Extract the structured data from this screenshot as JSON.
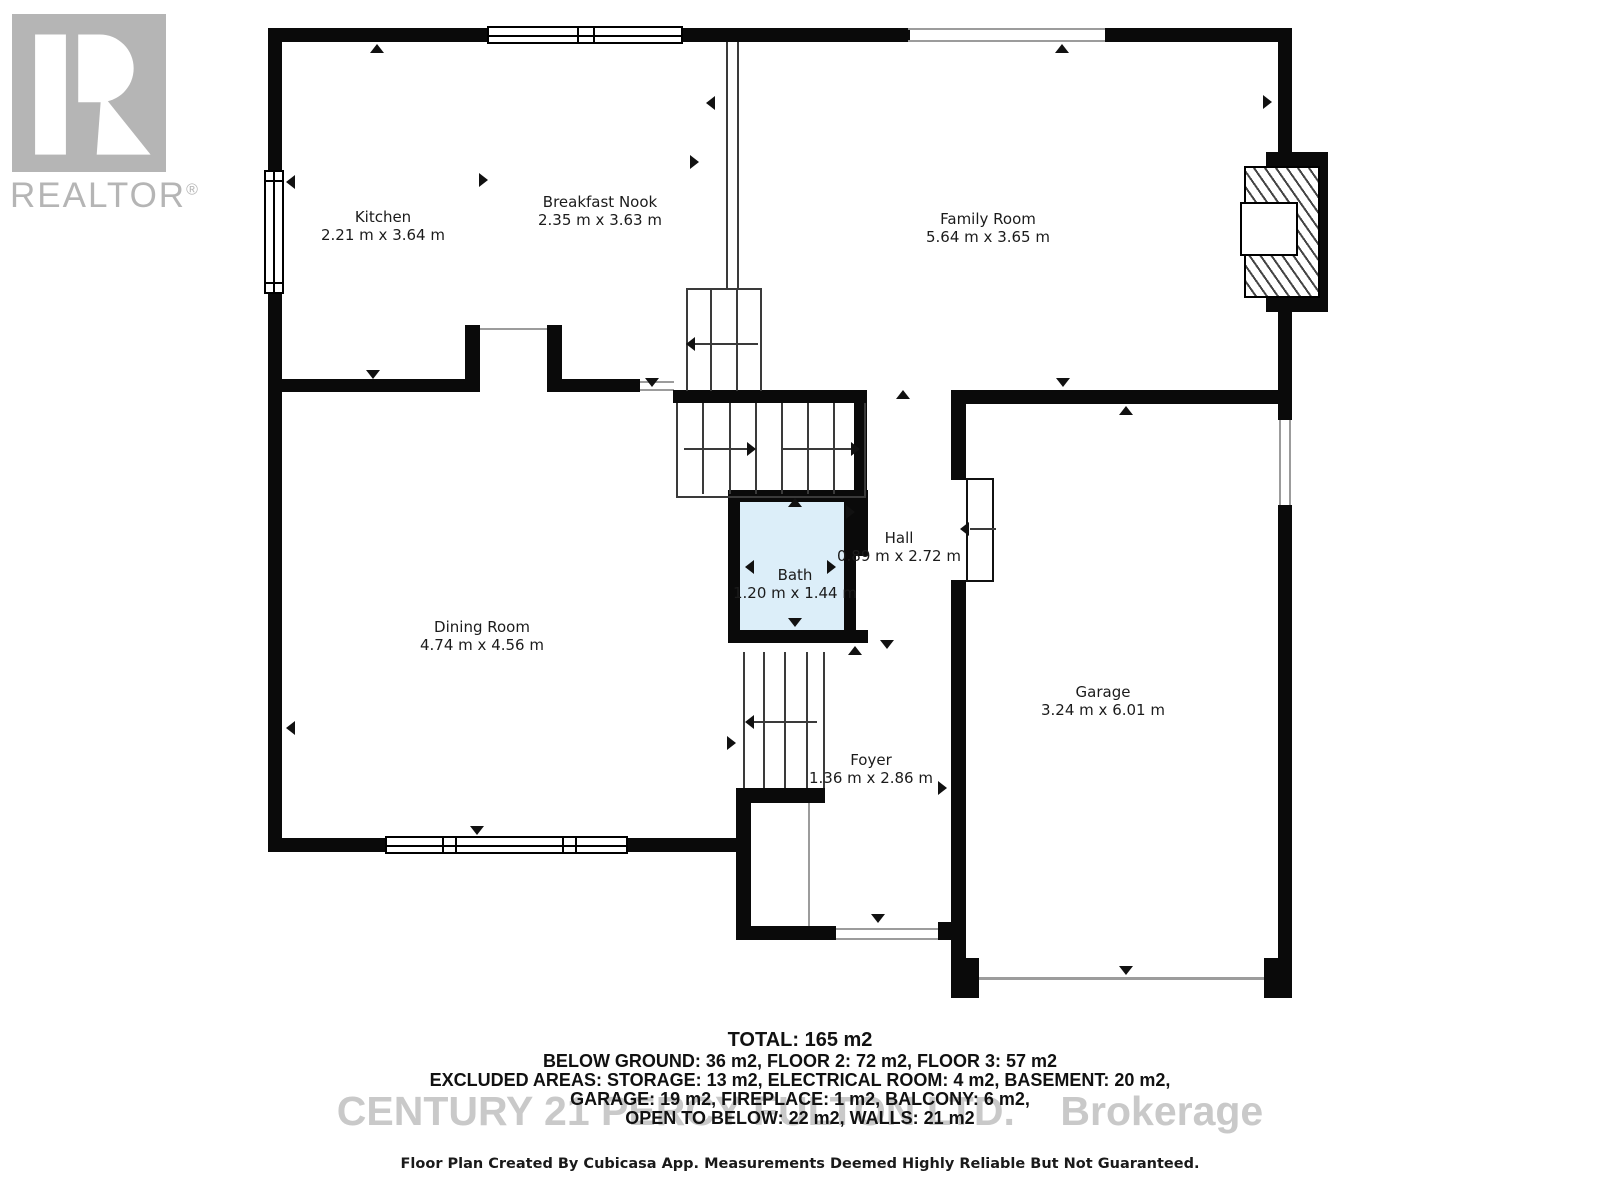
{
  "branding": {
    "logo_letter_box": "realtor-block-R",
    "logo_text": "REALTOR",
    "registered_mark": "®"
  },
  "rooms": [
    {
      "name": "Kitchen",
      "dims": "2.21 m x 3.64 m"
    },
    {
      "name": "Breakfast Nook",
      "dims": "2.35 m x 3.63 m"
    },
    {
      "name": "Family Room",
      "dims": "5.64 m x 3.65 m"
    },
    {
      "name": "Dining Room",
      "dims": "4.74 m x 4.56 m"
    },
    {
      "name": "Bath",
      "dims": "1.20 m x 1.44 m"
    },
    {
      "name": "Hall",
      "dims": "0.89 m x 2.72 m"
    },
    {
      "name": "Garage",
      "dims": "3.24 m x 6.01 m"
    },
    {
      "name": "Foyer",
      "dims": "1.36 m x 2.86 m"
    }
  ],
  "summary": {
    "total": "TOTAL: 165 m2",
    "lines": [
      "BELOW GROUND: 36 m2, FLOOR 2: 72 m2, FLOOR 3: 57 m2",
      "EXCLUDED AREAS: STORAGE: 13 m2, ELECTRICAL ROOM: 4 m2, BASEMENT: 20 m2,",
      "GARAGE: 19 m2, FIREPLACE: 1 m2, BALCONY: 6 m2,",
      "OPEN TO BELOW: 22 m2, WALLS: 21 m2"
    ]
  },
  "watermark": "CENTURY 21 PERCY FULTON LTD.    Brokerage",
  "disclaimer": "Floor Plan Created By Cubicasa App. Measurements Deemed Highly Reliable But Not Guaranteed.",
  "colors": {
    "wall": "#0a0a0a",
    "bath_fill": "#dceef9",
    "watermark_gray": "#c9c9c9",
    "logo_gray": "#b5b5b5"
  }
}
